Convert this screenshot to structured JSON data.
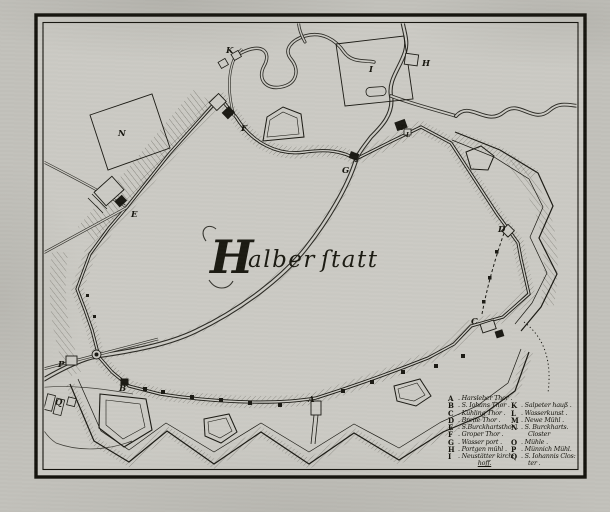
{
  "colors": {
    "paper": "#c2c1bb",
    "paper_light": "#cbcac4",
    "ink": "#1b1a14",
    "hatch": "#55534b"
  },
  "title": {
    "initial": "H",
    "rest": "alber",
    "part2": "ſtatt"
  },
  "map": {
    "markers": [
      {
        "id": "A",
        "x": 308,
        "y": 402
      },
      {
        "id": "B",
        "x": 119,
        "y": 391
      },
      {
        "id": "C",
        "x": 471,
        "y": 324
      },
      {
        "id": "D",
        "x": 498,
        "y": 232
      },
      {
        "id": "E",
        "x": 131,
        "y": 217
      },
      {
        "id": "F",
        "x": 241,
        "y": 131
      },
      {
        "id": "G",
        "x": 342,
        "y": 173
      },
      {
        "id": "H",
        "x": 422,
        "y": 66
      },
      {
        "id": "I",
        "x": 369,
        "y": 72
      },
      {
        "id": "K",
        "x": 226,
        "y": 53
      },
      {
        "id": "L",
        "x": 406,
        "y": 137,
        "small": true
      },
      {
        "id": "M",
        "x": 397,
        "y": 130,
        "small": true
      },
      {
        "id": "N",
        "x": 118,
        "y": 136
      },
      {
        "id": "P",
        "x": 58,
        "y": 367
      },
      {
        "id": "Q",
        "x": 55,
        "y": 405
      }
    ]
  },
  "legend": {
    "rows": [
      {
        "l": "A",
        "lt": ". Harsleber Thor .",
        "r": "",
        "rt": ""
      },
      {
        "l": "B",
        "lt": ". S. Iohans Thor .",
        "r": "K",
        "rt": ". Salpeter hauß ."
      },
      {
        "l": "C",
        "lt": ". Kühling Thor .",
        "r": "L",
        "rt": ". Wasserkunst ."
      },
      {
        "l": "D",
        "lt": ". Breite Thor .",
        "r": "M",
        "rt": ". Newe Mühl ."
      },
      {
        "l": "E",
        "lt": ". S.Burckhartsthor .",
        "r": "N",
        "rt": ". S. Burckharts."
      },
      {
        "l": "F",
        "lt": ". Groper Thor .",
        "r": "",
        "rt": "Closter"
      },
      {
        "l": "G",
        "lt": ". Wasser port .",
        "r": "O",
        "rt": ". Mühle ."
      },
      {
        "l": "H",
        "lt": ". Portgen mühl .",
        "r": "P",
        "rt": ". Münnich Mühl."
      },
      {
        "l": "I",
        "lt": ". Neustätter kirch:",
        "r": "Q",
        "rt": ". S. Iohannis Clos:"
      },
      {
        "l": "",
        "lt": "hoff.",
        "r": "",
        "rt": "ter ."
      }
    ]
  }
}
